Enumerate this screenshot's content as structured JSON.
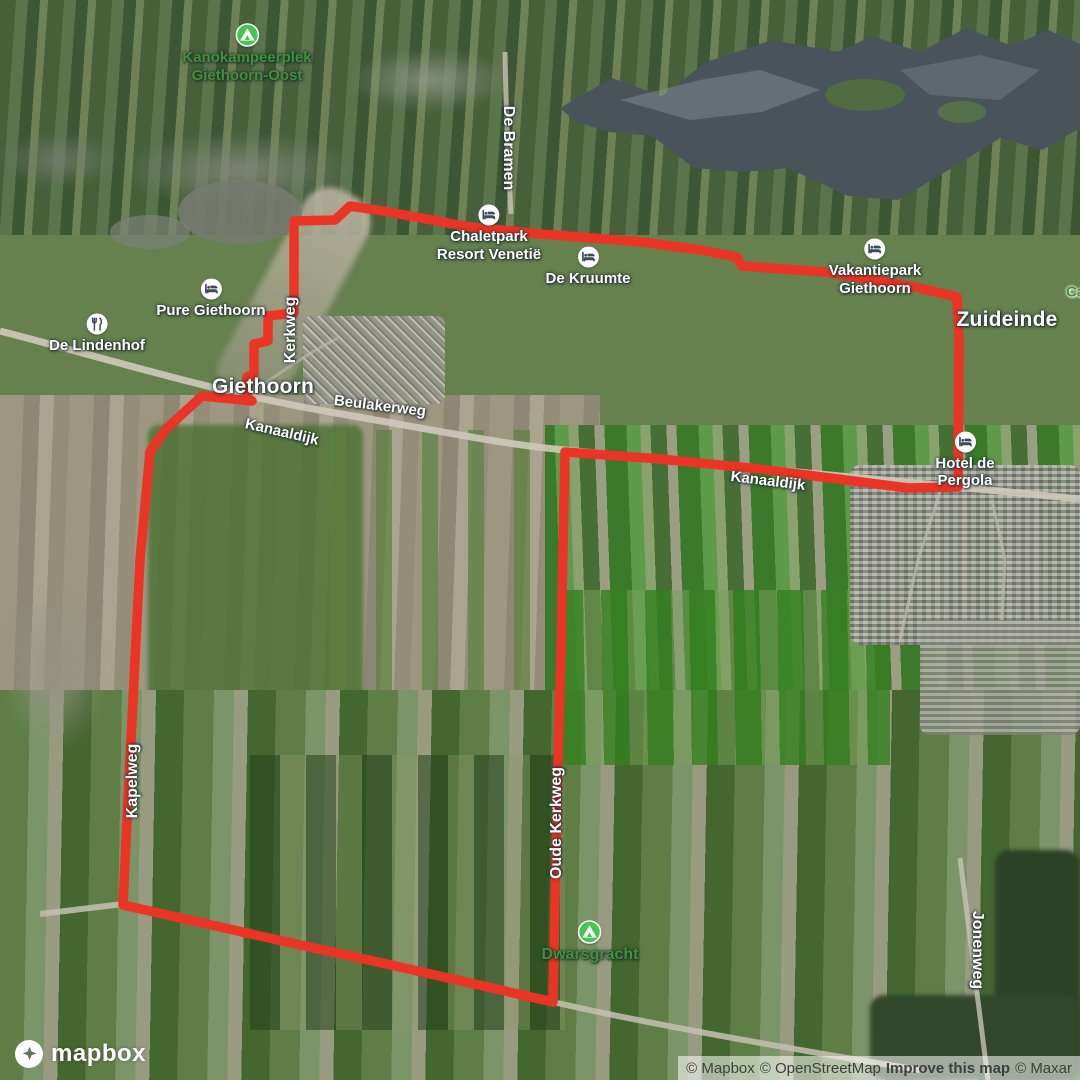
{
  "route": {
    "color": "#ea3425",
    "width": 9.5,
    "points": "294,221 335,220 350,206 383,211 470,227 540,234 642,242 700,250 737,257 742,266 825,272 915,287 957,297 959,340 958,487 908,488 830,478 760,469 660,459 565,452 561,650 557,800 553,1002 400,967 260,936 123,905 128,800 133,700 140,560 150,452 166,429 202,396 252,401 247,398 247,377 254,374 254,344 268,341 268,316 294,313 294,221"
  },
  "colors": {
    "park_label": "#3e9334",
    "campground_icon": "#46c455",
    "poi_glyph": "#3c4c57",
    "water": "#4a535c"
  },
  "labels": {
    "kanokampeerplek": {
      "line1": "Kanokampeerplek",
      "line2": "Giethoorn-Oost"
    },
    "de_bramen": "De Bramen",
    "chaletpark": {
      "line1": "Chaletpark",
      "line2": "Resort Venetië"
    },
    "de_kruumte": "De Kruumte",
    "vakantiepark": {
      "line1": "Vakantiepark",
      "line2": "Giethoorn"
    },
    "zuideinde": "Zuideinde",
    "camping_partial": "Ca",
    "pure_giethoorn": "Pure Giethoorn",
    "de_lindenhof": "De Lindenhof",
    "kerkweg": "Kerkweg",
    "giethoorn": "Giethoorn",
    "beulakerweg": "Beulakerweg",
    "kanaaldijk_west": "Kanaaldijk",
    "kanaaldijk_east": "Kanaaldijk",
    "hotel_de_pergola": "Hotel de Pergola",
    "kapelweg": "Kapelweg",
    "oude_kerkweg": "Oude Kerkweg",
    "dwarsgracht": "Dwarsgracht",
    "jonenweg": "Jonenweg"
  },
  "logo": {
    "wordmark": "mapbox"
  },
  "attribution": {
    "mapbox": "© Mapbox",
    "osm": "© OpenStreetMap",
    "improve": "Improve this map",
    "maxar": "© Maxar"
  }
}
